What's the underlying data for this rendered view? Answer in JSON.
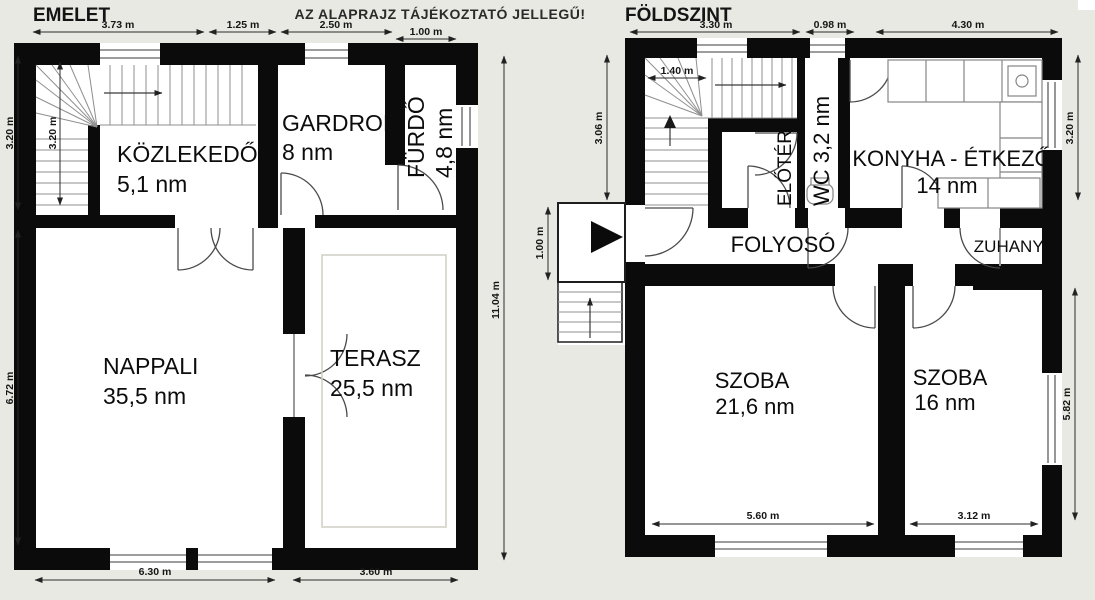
{
  "header": {
    "emelet_title": "EMELET",
    "foldszint_title": "FÖLDSZINT",
    "note": "AZ ALAPRAJZ TÁJÉKOZTATÓ JELLEGŰ!"
  },
  "emelet": {
    "rooms": {
      "kozlekedo": {
        "name": "KÖZLEKEDŐ",
        "area": "5,1 nm"
      },
      "gardrob": {
        "name": "GARDROB",
        "area": "8 nm"
      },
      "furdo": {
        "name": "FÜRDŐ",
        "area": "4,8 nm"
      },
      "nappali": {
        "name": "NAPPALI",
        "area": "35,5 nm"
      },
      "terasz": {
        "name": "TERASZ",
        "area": "25,5 nm"
      }
    },
    "dims": {
      "top_1": "3.73 m",
      "top_2": "1.25 m",
      "top_3": "2.50 m",
      "top_4": "1.00 m",
      "left_upper": "3.20 m",
      "left_lower": "6.72 m",
      "stair_inner": "3.20 m",
      "right": "11.04 m",
      "bottom_1": "6.30 m",
      "bottom_2": "3.60 m"
    }
  },
  "foldszint": {
    "rooms": {
      "eloter": {
        "name": "ELŐTÉR"
      },
      "wc": {
        "name": "WC 3,2 nm"
      },
      "konyha": {
        "name": "KONYHA - ÉTKEZŐ",
        "area": "14 nm"
      },
      "folyoso": {
        "name": "FOLYOSÓ"
      },
      "zuhany": {
        "name": "ZUHANY."
      },
      "szoba_nagy": {
        "name": "SZOBA",
        "area": "21,6 nm"
      },
      "szoba_kis": {
        "name": "SZOBA",
        "area": "16 nm"
      }
    },
    "dims": {
      "top_1": "3.30 m",
      "top_2": "0.98 m",
      "top_3": "4.30 m",
      "left_upper": "3.06 m",
      "left_lower": "1.00 m",
      "stair_inner": "1.40 m",
      "right_upper": "3.20 m",
      "right_lower": "5.82 m",
      "bottom_1": "5.60 m",
      "bottom_2": "3.12 m"
    }
  },
  "colors": {
    "background": "#e9e9e3",
    "wall": "#0b0b0b",
    "interior": "#ffffff",
    "window": "#7d7d7d"
  }
}
